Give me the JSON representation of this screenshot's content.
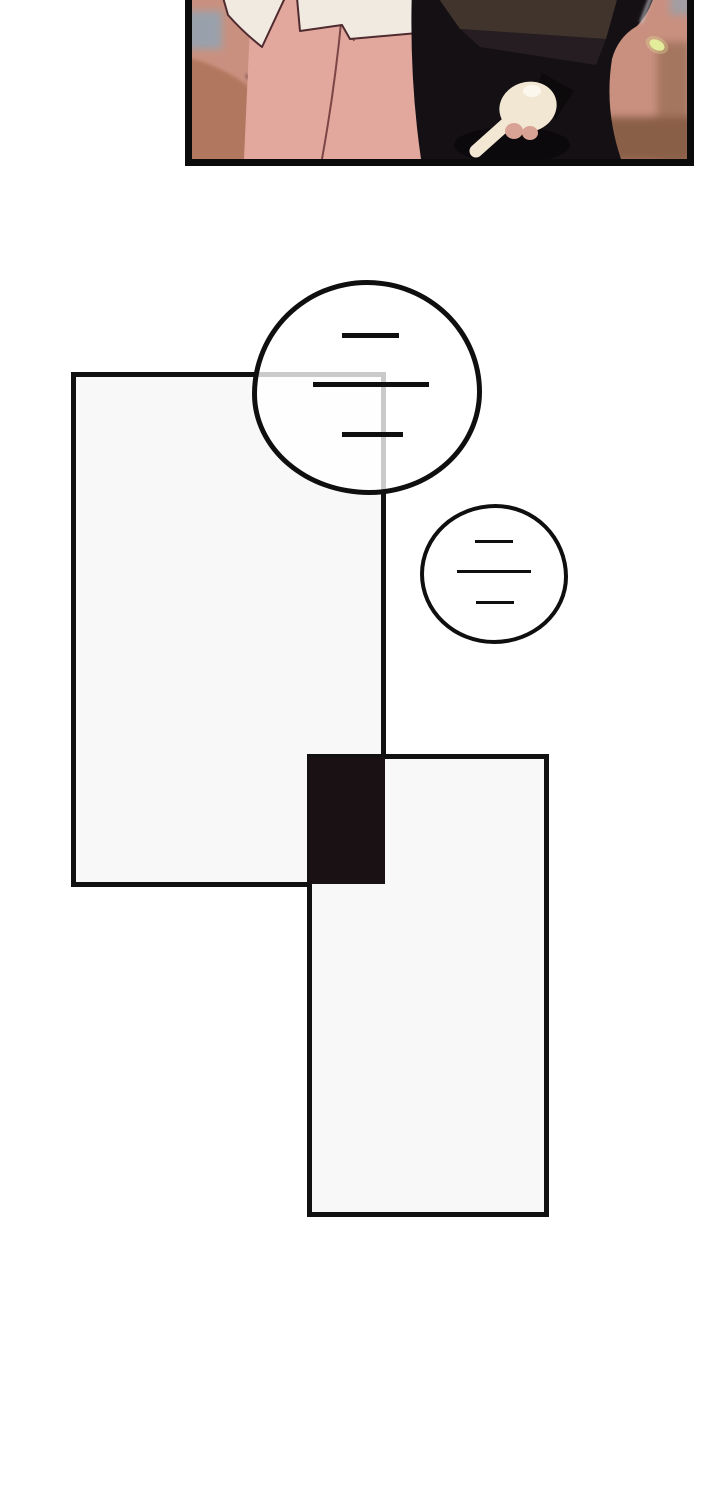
{
  "page": {
    "type": "webtoon comic page",
    "background": "#ffffff"
  },
  "photo_panel": {
    "description": "cropped illustration: person in white jacket and pink skirt beside person in black suit; pale hand pointing downward",
    "border_color": "#0b0b0b",
    "background_color": "#c9907f",
    "colors": {
      "window_blur": "#98a1ab",
      "wall_right_blur": "#a5765f",
      "floor_corner_blur": "#8a5e47",
      "floor_blob": "#b2785e",
      "skirt": "#e2a89d",
      "skirt_seam": "#7c4545",
      "jacket": "#f0eae1",
      "jacket_outline": "#4f2a2e",
      "suit": "#141014",
      "suit_facet": "#46392f",
      "suit_facet_dark": "#2b2126",
      "suit_shadow": "#0a0709",
      "hand": "#f2e7d3",
      "hand_highlight": "#fbf7ec",
      "knuckles": "#d8a294",
      "cuff": "#0d0a0c",
      "edge_highlight": "#c9c9d0",
      "glint": "#e3ec9a"
    }
  },
  "panels": [
    {
      "name": "panel-1",
      "fill": "#f9f8f8",
      "border": "#111111"
    },
    {
      "name": "panel-2",
      "fill": "#f9f8f8",
      "border": "#111111"
    },
    {
      "name": "panel-overlap",
      "fill": "#1a1115"
    }
  ],
  "speech_bubbles": [
    {
      "name": "bubble-large",
      "line_count": 3,
      "border": "#0f0f0f",
      "fill": "rgba(255,255,255,0.78)"
    },
    {
      "name": "bubble-small",
      "line_count": 3,
      "border": "#0f0f0f",
      "fill": "rgba(255,255,255,0.85)"
    }
  ]
}
